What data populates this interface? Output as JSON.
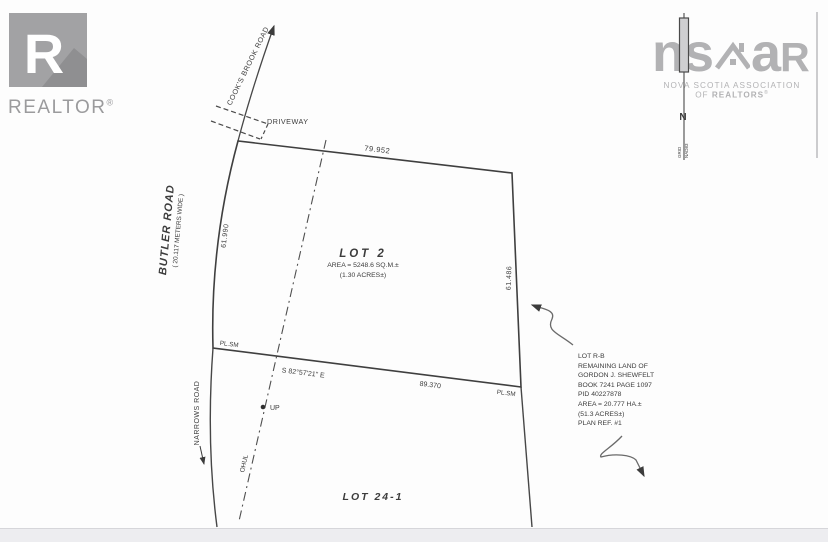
{
  "realtor_logo": {
    "letter": "R",
    "label": "REALTOR",
    "reg": "®"
  },
  "nsar_logo": {
    "part1": "ns",
    "part2": "a",
    "part3": "R",
    "line1": "NOVA SCOTIA ASSOCIATION",
    "line2a": "OF",
    "line2b": "REALTORS",
    "reg": "®"
  },
  "north": {
    "n": "N",
    "grid": "GRID",
    "datum": "NAD83"
  },
  "roads": {
    "cooks_brook": "COOK'S BROOK ROAD",
    "driveway": "DRIVEWAY",
    "butler_name": "BUTLER ROAD",
    "butler_width": "( 20.117 METERS WIDE )",
    "narrows": "NARROWS ROAD"
  },
  "lot2": {
    "name": "LOT 2",
    "area": "AREA = 5248.6 SQ.M.±",
    "acres": "(1.30 ACRES±)"
  },
  "lot24_1": {
    "name": "LOT 24-1"
  },
  "lot_rb": {
    "lines": [
      "LOT R-B",
      "REMAINING LAND OF",
      "GORDON J. SHEWFELT",
      "BOOK 7241 PAGE 1097",
      "PID 40227878",
      "AREA = 20.777 HA.±",
      "(51.3 ACRES±)",
      "PLAN REF. #1"
    ]
  },
  "dims": {
    "north_line": "79.952",
    "west_line": "61.990",
    "east_line": "61.486",
    "south_bearing": "S 82°57'21\" E",
    "south_line": "89.370",
    "marker_sw": "PL.SM",
    "marker_se": "PL.SM",
    "utility_line": "OHUL",
    "utility_pole": "UP"
  },
  "colors": {
    "line": "#474747",
    "label": "#3c3c3c",
    "realtor_grey": "#a2a2a4",
    "nsar_grey": "#b2b2b4"
  }
}
